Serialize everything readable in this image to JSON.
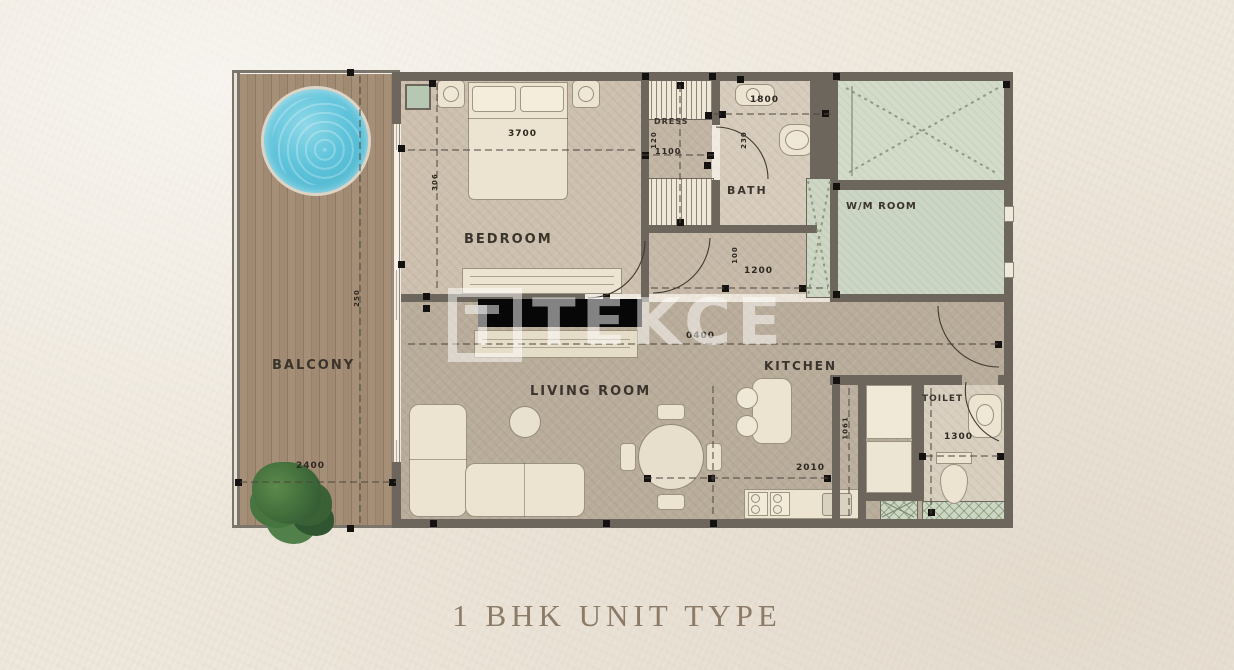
{
  "title": "1 BHK UNIT TYPE",
  "watermark": {
    "text": "TEKCE"
  },
  "rooms": {
    "balcony": "BALCONY",
    "bedroom": "BEDROOM",
    "living": "LIVING ROOM",
    "kitchen": "KITCHEN",
    "bath": "BATH",
    "dress": "DRESS",
    "wm_room": "W/M ROOM",
    "toilet": "TOILET"
  },
  "dimensions": {
    "bedroom_w": "3700",
    "bedroom_d": "306",
    "balcony_w": "2400",
    "balcony_d": "250",
    "dress_w": "1100",
    "dress_d": "120",
    "bath_w": "1800",
    "bath_d": "230",
    "hall_w": "1200",
    "hall_d": "100",
    "living_c": "0400",
    "kitchen_w": "2010",
    "kitchen_d": "1061",
    "toilet_w": "1300"
  },
  "colors": {
    "wall": "#6c665c",
    "floor": "#c0b3a2",
    "balcony_wood": "#a18b73",
    "pool": "#5ec3da",
    "sage_room": "#ced8c5",
    "tv_unit": "#070707",
    "label_text": "#3a342c",
    "title_text": "#8c7b67",
    "watermark_white": "rgba(255,255,255,0.5)"
  }
}
